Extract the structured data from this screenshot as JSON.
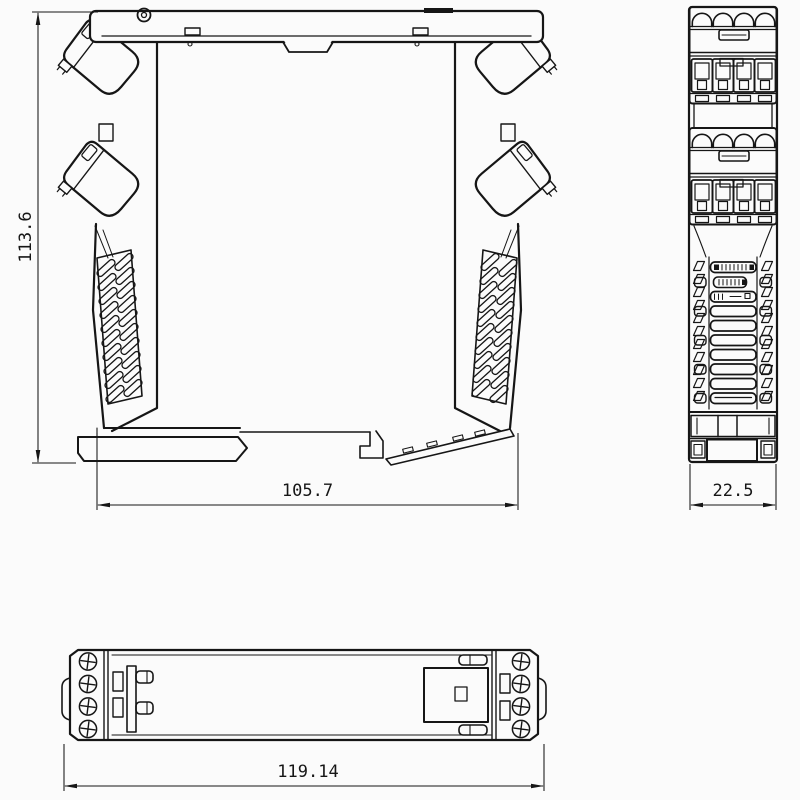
{
  "drawing": {
    "background": "#fbfbfb",
    "line_color": "#161616",
    "type": "engineering-dimension-drawing",
    "subject": "din-rail-enclosure-module",
    "dimensions": {
      "side_height": "113.6",
      "side_width": "105.7",
      "front_width": "22.5",
      "top_length": "119.14"
    }
  }
}
